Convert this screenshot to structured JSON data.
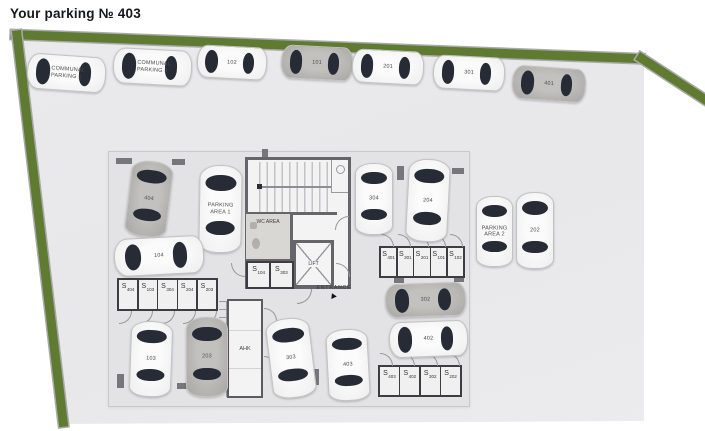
{
  "header": {
    "title": "Your parking № 403"
  },
  "plan": {
    "storage_prefix": "S",
    "rooms": {
      "wc": "WC AREA",
      "lift": "LIFT",
      "ahk": "AHK",
      "entrance": "ENTRANCE"
    },
    "colors": {
      "wall_green": "#5e7b31",
      "floor_gray": "#e9e9eb",
      "block_gray": "#e3e3e5",
      "building_wall": "#66666a",
      "car_window": "#262b35",
      "car_white": "#f5f5f5",
      "car_gray": "#b5b3b0"
    },
    "cars": [
      {
        "label": "COMMUNAL PARKING 1"
      },
      {
        "label": "COMMUNAL PARKING 2"
      },
      {
        "label": "102"
      },
      {
        "label": "101"
      },
      {
        "label": "201"
      },
      {
        "label": "301"
      },
      {
        "label": "401"
      },
      {
        "label": "404"
      },
      {
        "label": "PARKING AREA 1"
      },
      {
        "label": "104"
      },
      {
        "label": "103"
      },
      {
        "label": "203"
      },
      {
        "label": "303"
      },
      {
        "label": "403"
      },
      {
        "label": "304"
      },
      {
        "label": "204"
      },
      {
        "label": "302"
      },
      {
        "label": "402"
      },
      {
        "label": "PARKING AREA 2"
      },
      {
        "label": "202"
      }
    ],
    "storage_rows": {
      "left": [
        "404",
        "103",
        "304",
        "204",
        "203"
      ],
      "right": [
        "401",
        "301",
        "201",
        "101",
        "102"
      ],
      "bottom": [
        "403",
        "402",
        "302",
        "202"
      ],
      "building": [
        "104",
        "303"
      ]
    }
  }
}
